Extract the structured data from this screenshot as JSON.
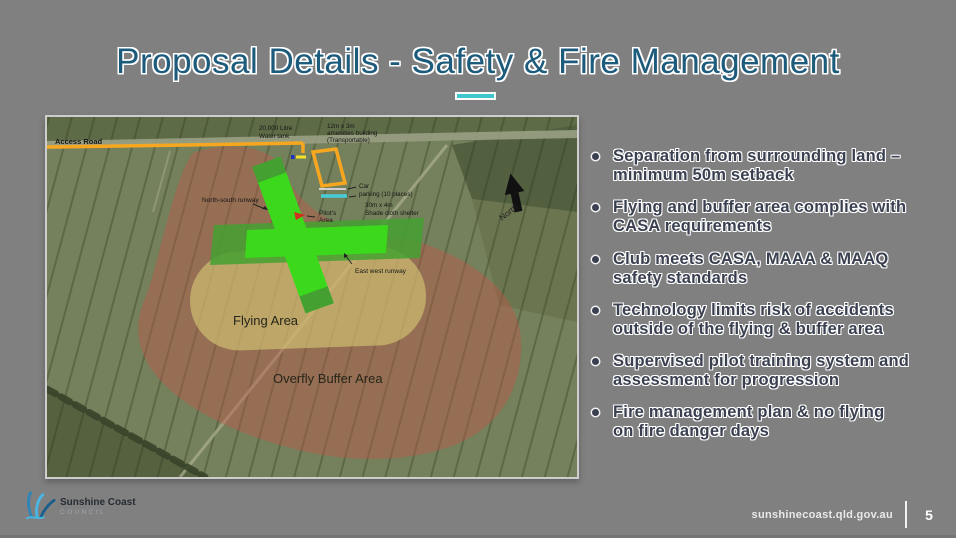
{
  "colors": {
    "slide_background": "#808080",
    "title_text": "#1d5b7c",
    "title_underline": "#3fc8cc",
    "bullet_text": "#3a4050",
    "overfly_buffer_fill": "#c05548",
    "flying_area_fill": "#ded67a",
    "runway_bright_green": "#3bd81b",
    "runway_dark_green": "#44a131",
    "access_road_orange": "#f7a71f",
    "shade_shelter_cyan": "#49ccd9",
    "footer_text": "#e9e9e9"
  },
  "header": {
    "title": "Proposal Details - Safety & Fire Management"
  },
  "bullets": [
    {
      "lines": [
        "Separation from surrounding land –",
        "minimum 50m setback"
      ]
    },
    {
      "lines": [
        "Flying and buffer area complies with",
        "CASA requirements"
      ]
    },
    {
      "lines": [
        "Club meets CASA, MAAA & MAAQ",
        "safety standards"
      ]
    },
    {
      "lines": [
        "Technology limits risk of accidents",
        "outside of the flying & buffer area"
      ]
    },
    {
      "lines": [
        "Supervised pilot training system and",
        "assessment for progression"
      ]
    },
    {
      "lines": [
        "Fire management plan & no flying",
        "on fire danger days"
      ]
    }
  ],
  "map": {
    "labels": {
      "access_road": "Access Road",
      "water_tank_line1": "20,000 Litre",
      "water_tank_line2": "Water tank",
      "amenities_line1": "12m x 3m",
      "amenities_line2": "amenities building",
      "amenities_line3": "(Transportable)",
      "car_parking_line1": "Car",
      "car_parking_line2": "parking (10 places)",
      "shade_line1": "30m x 4m",
      "shade_line2": "Shade cloth shelter",
      "north_south_runway": "North-south runway",
      "pilots_area_line1": "Pilot's",
      "pilots_area_line2": "Area",
      "east_west_runway": "East west runway",
      "flying_area": "Flying Area",
      "overfly_buffer": "Overfly Buffer Area",
      "north": "North"
    }
  },
  "footer": {
    "logo_name": "Sunshine Coast",
    "logo_subtitle": "COUNCIL",
    "website": "sunshinecoast.qld.gov.au",
    "page_number": "5"
  }
}
